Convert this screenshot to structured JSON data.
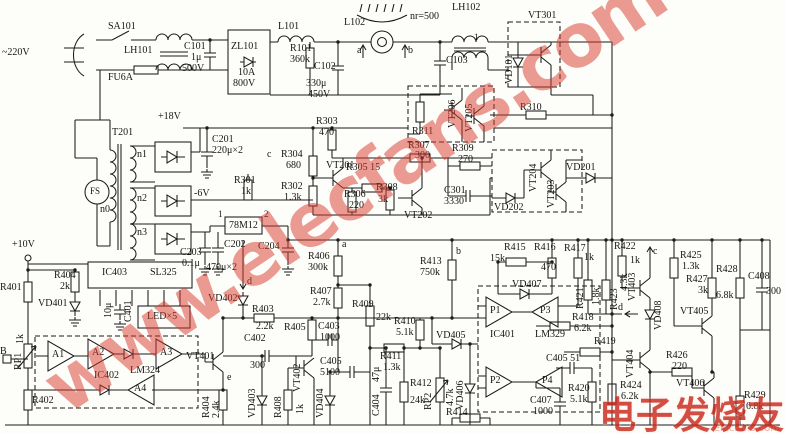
{
  "doc": {
    "kind": "scanned circuit schematic (induction cooker power & control board)",
    "ink": "#1c1c1c",
    "paper": "#fdfdfa"
  },
  "watermark": {
    "diagonal": "www.elecfans.com",
    "corner_cn": "电子发烧友",
    "corner_en": "elecfans.com",
    "color": "#d93a2b"
  },
  "labels": [
    {
      "t": "SA101",
      "x": 108,
      "y": 22
    },
    {
      "t": "~220V",
      "x": 2,
      "y": 48
    },
    {
      "t": "LH101",
      "x": 124,
      "y": 46
    },
    {
      "t": "FU6A",
      "x": 108,
      "y": 73
    },
    {
      "t": "C101",
      "x": 184,
      "y": 42
    },
    {
      "t": "1μ",
      "x": 191,
      "y": 53
    },
    {
      "t": "500V",
      "x": 182,
      "y": 64
    },
    {
      "t": "ZL101",
      "x": 231,
      "y": 42
    },
    {
      "t": "10A",
      "x": 238,
      "y": 68
    },
    {
      "t": "800V",
      "x": 233,
      "y": 79
    },
    {
      "t": "L101",
      "x": 278,
      "y": 22
    },
    {
      "t": "R101",
      "x": 290,
      "y": 44
    },
    {
      "t": "360k",
      "x": 290,
      "y": 55
    },
    {
      "t": "C102",
      "x": 314,
      "y": 62
    },
    {
      "t": "330μ",
      "x": 306,
      "y": 79
    },
    {
      "t": "450V",
      "x": 308,
      "y": 90
    },
    {
      "t": "L102",
      "x": 344,
      "y": 18
    },
    {
      "t": "a",
      "x": 357,
      "y": 46
    },
    {
      "t": "b",
      "x": 408,
      "y": 46
    },
    {
      "t": "nr=500",
      "x": 410,
      "y": 12
    },
    {
      "t": "LH102",
      "x": 452,
      "y": 3
    },
    {
      "t": "1",
      "x": 474,
      "y": 33,
      "s": 9
    },
    {
      "t": "C103",
      "x": 446,
      "y": 56
    },
    {
      "t": "VD101",
      "x": 505,
      "y": 84,
      "v": 1
    },
    {
      "t": "VT301",
      "x": 528,
      "y": 11
    },
    {
      "t": "R310",
      "x": 520,
      "y": 103
    },
    {
      "t": "T201",
      "x": 112,
      "y": 128
    },
    {
      "t": "+18V",
      "x": 158,
      "y": 112
    },
    {
      "t": "C201",
      "x": 212,
      "y": 135
    },
    {
      "t": "220μ×2",
      "x": 212,
      "y": 146
    },
    {
      "t": "n1",
      "x": 137,
      "y": 150
    },
    {
      "t": "n2",
      "x": 137,
      "y": 194
    },
    {
      "t": "n3",
      "x": 137,
      "y": 228
    },
    {
      "t": "n0",
      "x": 100,
      "y": 205
    },
    {
      "t": "FS",
      "x": 90,
      "y": 187,
      "s": 9
    },
    {
      "t": "-6V",
      "x": 194,
      "y": 189
    },
    {
      "t": "R301",
      "x": 234,
      "y": 176
    },
    {
      "t": "1k",
      "x": 241,
      "y": 187
    },
    {
      "t": "R303",
      "x": 316,
      "y": 117
    },
    {
      "t": "470",
      "x": 319,
      "y": 128
    },
    {
      "t": "c",
      "x": 267,
      "y": 150
    },
    {
      "t": "R304",
      "x": 281,
      "y": 150
    },
    {
      "t": "680",
      "x": 286,
      "y": 161
    },
    {
      "t": "R302",
      "x": 281,
      "y": 182
    },
    {
      "t": "1.3k",
      "x": 284,
      "y": 193
    },
    {
      "t": "VT201",
      "x": 326,
      "y": 161
    },
    {
      "t": "R305 15",
      "x": 346,
      "y": 163
    },
    {
      "t": "R306",
      "x": 344,
      "y": 190
    },
    {
      "t": "220",
      "x": 349,
      "y": 201
    },
    {
      "t": "R307",
      "x": 408,
      "y": 141
    },
    {
      "t": "300",
      "x": 415,
      "y": 151
    },
    {
      "t": "R308",
      "x": 376,
      "y": 183
    },
    {
      "t": "3k",
      "x": 378,
      "y": 195
    },
    {
      "t": "VT202",
      "x": 404,
      "y": 211
    },
    {
      "t": "R309",
      "x": 452,
      "y": 144
    },
    {
      "t": "270",
      "x": 458,
      "y": 155
    },
    {
      "t": "C301",
      "x": 444,
      "y": 186
    },
    {
      "t": "3330",
      "x": 444,
      "y": 197
    },
    {
      "t": "R311",
      "x": 412,
      "y": 127
    },
    {
      "t": "VT206",
      "x": 448,
      "y": 128,
      "v": 1
    },
    {
      "t": "VT205",
      "x": 465,
      "y": 132,
      "v": 1
    },
    {
      "t": "VD202",
      "x": 494,
      "y": 203
    },
    {
      "t": "VT204",
      "x": 529,
      "y": 192,
      "v": 1
    },
    {
      "t": "VT203",
      "x": 547,
      "y": 208,
      "v": 1
    },
    {
      "t": "VD201",
      "x": 566,
      "y": 163
    },
    {
      "t": "78M12",
      "x": 229,
      "y": 221
    },
    {
      "t": "1",
      "x": 218,
      "y": 210,
      "s": 9
    },
    {
      "t": "2",
      "x": 264,
      "y": 210,
      "s": 9
    },
    {
      "t": "C203",
      "x": 180,
      "y": 248
    },
    {
      "t": "0.1μ",
      "x": 182,
      "y": 259
    },
    {
      "t": "C202",
      "x": 224,
      "y": 240
    },
    {
      "t": "470μ×2",
      "x": 206,
      "y": 263
    },
    {
      "t": "C204",
      "x": 258,
      "y": 242
    },
    {
      "t": "+10V",
      "x": 12,
      "y": 240
    },
    {
      "t": "R401",
      "x": 0,
      "y": 283
    },
    {
      "t": "R404",
      "x": 54,
      "y": 271
    },
    {
      "t": "2k",
      "x": 60,
      "y": 282
    },
    {
      "t": "VD401",
      "x": 38,
      "y": 299
    },
    {
      "t": "IC403",
      "x": 102,
      "y": 268
    },
    {
      "t": "SL325",
      "x": 150,
      "y": 268
    },
    {
      "t": "10μ",
      "x": 104,
      "y": 318,
      "v": 1
    },
    {
      "t": "C401",
      "x": 124,
      "y": 322,
      "v": 1
    },
    {
      "t": "LED×5",
      "x": 147,
      "y": 312
    },
    {
      "t": "B",
      "x": 0,
      "y": 347
    },
    {
      "t": "1k",
      "x": 16,
      "y": 344,
      "v": 1
    },
    {
      "t": "RP1",
      "x": 14,
      "y": 370,
      "v": 1
    },
    {
      "t": "A1",
      "x": 52,
      "y": 350
    },
    {
      "t": "A2",
      "x": 92,
      "y": 348
    },
    {
      "t": "A3",
      "x": 160,
      "y": 348
    },
    {
      "t": "A4",
      "x": 134,
      "y": 384
    },
    {
      "t": "IC402",
      "x": 94,
      "y": 371
    },
    {
      "t": "LM324",
      "x": 130,
      "y": 366
    },
    {
      "t": "R402",
      "x": 32,
      "y": 396
    },
    {
      "t": "d",
      "x": 247,
      "y": 277
    },
    {
      "t": "VD402",
      "x": 208,
      "y": 294
    },
    {
      "t": "R403",
      "x": 252,
      "y": 305
    },
    {
      "t": "2.2k",
      "x": 256,
      "y": 322
    },
    {
      "t": "R405",
      "x": 284,
      "y": 323
    },
    {
      "t": "a",
      "x": 342,
      "y": 240
    },
    {
      "t": "R406",
      "x": 308,
      "y": 252
    },
    {
      "t": "300k",
      "x": 308,
      "y": 263
    },
    {
      "t": "R407",
      "x": 310,
      "y": 287
    },
    {
      "t": "2.7k",
      "x": 313,
      "y": 298
    },
    {
      "t": "C403",
      "x": 318,
      "y": 322
    },
    {
      "t": "1000",
      "x": 320,
      "y": 333
    },
    {
      "t": "C405",
      "x": 320,
      "y": 357
    },
    {
      "t": "5100",
      "x": 320,
      "y": 368
    },
    {
      "t": "VT401",
      "x": 186,
      "y": 352
    },
    {
      "t": "e",
      "x": 227,
      "y": 373
    },
    {
      "t": "C402",
      "x": 244,
      "y": 334
    },
    {
      "t": "300",
      "x": 250,
      "y": 361
    },
    {
      "t": "VT402",
      "x": 293,
      "y": 392,
      "v": 1
    },
    {
      "t": "R404",
      "x": 202,
      "y": 418,
      "v": 1
    },
    {
      "t": "2.4k",
      "x": 212,
      "y": 418,
      "v": 1
    },
    {
      "t": "VD403",
      "x": 248,
      "y": 418,
      "v": 1
    },
    {
      "t": "R408",
      "x": 274,
      "y": 418,
      "v": 1
    },
    {
      "t": "1k",
      "x": 296,
      "y": 414,
      "v": 1
    },
    {
      "t": "VD404",
      "x": 316,
      "y": 418,
      "v": 1
    },
    {
      "t": "R409",
      "x": 352,
      "y": 300
    },
    {
      "t": "22k",
      "x": 376,
      "y": 313
    },
    {
      "t": "R410",
      "x": 394,
      "y": 317
    },
    {
      "t": "5.1k",
      "x": 396,
      "y": 328
    },
    {
      "t": "R411",
      "x": 380,
      "y": 352
    },
    {
      "t": "1.3k",
      "x": 383,
      "y": 363
    },
    {
      "t": "R412",
      "x": 410,
      "y": 379
    },
    {
      "t": "24k",
      "x": 410,
      "y": 396
    },
    {
      "t": "47μ",
      "x": 372,
      "y": 382,
      "v": 1
    },
    {
      "t": "C404",
      "x": 372,
      "y": 416,
      "v": 1
    },
    {
      "t": "RP2",
      "x": 424,
      "y": 410,
      "v": 1
    },
    {
      "t": "4.7k",
      "x": 446,
      "y": 406,
      "v": 1
    },
    {
      "t": "VD405",
      "x": 436,
      "y": 331
    },
    {
      "t": "VD406",
      "x": 456,
      "y": 410,
      "v": 1
    },
    {
      "t": "R413",
      "x": 420,
      "y": 257
    },
    {
      "t": "750k",
      "x": 420,
      "y": 268
    },
    {
      "t": "b",
      "x": 456,
      "y": 247
    },
    {
      "t": "R414",
      "x": 446,
      "y": 408
    },
    {
      "t": "R415",
      "x": 504,
      "y": 243
    },
    {
      "t": "15k",
      "x": 490,
      "y": 254
    },
    {
      "t": "R416",
      "x": 534,
      "y": 243
    },
    {
      "t": "470",
      "x": 541,
      "y": 263
    },
    {
      "t": "VD407",
      "x": 512,
      "y": 280
    },
    {
      "t": "R417",
      "x": 564,
      "y": 244
    },
    {
      "t": "1k",
      "x": 584,
      "y": 253
    },
    {
      "t": "R421",
      "x": 576,
      "y": 309,
      "v": 1
    },
    {
      "t": "1.8k",
      "x": 592,
      "y": 305,
      "v": 1
    },
    {
      "t": "R423",
      "x": 610,
      "y": 310,
      "v": 1
    },
    {
      "t": "4.3k",
      "x": 620,
      "y": 291,
      "v": 1
    },
    {
      "t": "d",
      "x": 618,
      "y": 303
    },
    {
      "t": "P1",
      "x": 490,
      "y": 306
    },
    {
      "t": "P3",
      "x": 540,
      "y": 306
    },
    {
      "t": "P2",
      "x": 490,
      "y": 376
    },
    {
      "t": "P4",
      "x": 542,
      "y": 376
    },
    {
      "t": "IC401",
      "x": 490,
      "y": 330
    },
    {
      "t": "LM329",
      "x": 535,
      "y": 330
    },
    {
      "t": "R418",
      "x": 572,
      "y": 313
    },
    {
      "t": "6.2k",
      "x": 574,
      "y": 324
    },
    {
      "t": "R419",
      "x": 594,
      "y": 337
    },
    {
      "t": "C405 51",
      "x": 546,
      "y": 354
    },
    {
      "t": "R420",
      "x": 568,
      "y": 384
    },
    {
      "t": "5.1k",
      "x": 570,
      "y": 395
    },
    {
      "t": "C407",
      "x": 530,
      "y": 396
    },
    {
      "t": "1000",
      "x": 533,
      "y": 407
    },
    {
      "t": "R424",
      "x": 620,
      "y": 381
    },
    {
      "t": "6.2k",
      "x": 621,
      "y": 392
    },
    {
      "t": "R422",
      "x": 614,
      "y": 242
    },
    {
      "t": "1k",
      "x": 630,
      "y": 256
    },
    {
      "t": "c",
      "x": 653,
      "y": 247
    },
    {
      "t": "VT403",
      "x": 628,
      "y": 301,
      "v": 1
    },
    {
      "t": "VD408",
      "x": 654,
      "y": 330,
      "v": 1
    },
    {
      "t": "VT404",
      "x": 626,
      "y": 378,
      "v": 1
    },
    {
      "t": "R425",
      "x": 680,
      "y": 251
    },
    {
      "t": "1.3k",
      "x": 682,
      "y": 262
    },
    {
      "t": "R427",
      "x": 686,
      "y": 275
    },
    {
      "t": "3k",
      "x": 698,
      "y": 286
    },
    {
      "t": "R428",
      "x": 716,
      "y": 265
    },
    {
      "t": "6.8k",
      "x": 716,
      "y": 291
    },
    {
      "t": "C408",
      "x": 748,
      "y": 272
    },
    {
      "t": "300",
      "x": 766,
      "y": 287
    },
    {
      "t": "VT405",
      "x": 680,
      "y": 307
    },
    {
      "t": "R426",
      "x": 666,
      "y": 351
    },
    {
      "t": "220",
      "x": 672,
      "y": 362
    },
    {
      "t": "VT406",
      "x": 676,
      "y": 379
    },
    {
      "t": "R429",
      "x": 744,
      "y": 391
    },
    {
      "t": "6.8k",
      "x": 746,
      "y": 402
    }
  ]
}
